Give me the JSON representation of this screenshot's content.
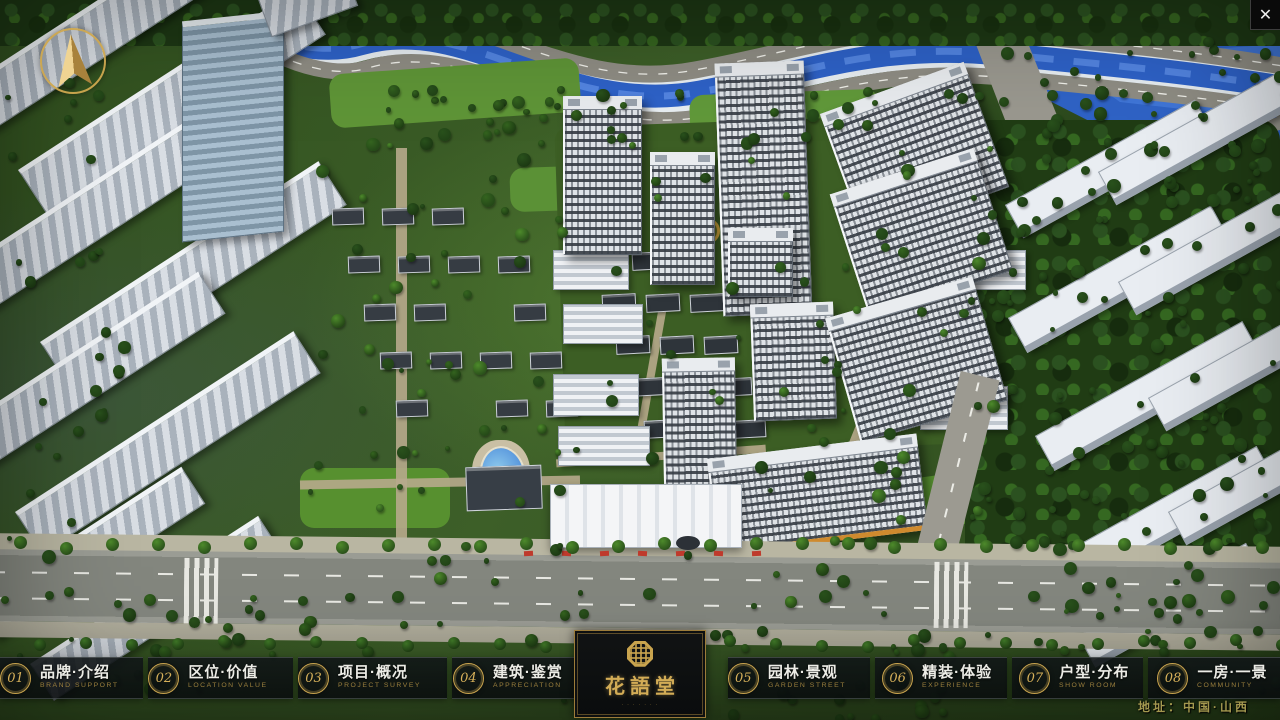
{
  "window": {
    "close_glyph": "✕"
  },
  "project": {
    "logo_title": "花語堂",
    "logo_subtitle": "· · · · · · ·",
    "address": "地址：中国·山西"
  },
  "nav": {
    "items": [
      {
        "num": "01",
        "title": "品牌·介绍",
        "subtitle": "BRAND SUPPORT"
      },
      {
        "num": "02",
        "title": "区位·价值",
        "subtitle": "LOCATION VALUE"
      },
      {
        "num": "03",
        "title": "项目·概况",
        "subtitle": "PROJECT SURVEY"
      },
      {
        "num": "04",
        "title": "建筑·鉴赏",
        "subtitle": "APPRECIATION"
      },
      {
        "num": "05",
        "title": "园林·景观",
        "subtitle": "GARDEN STREET"
      },
      {
        "num": "06",
        "title": "精装·体验",
        "subtitle": "EXPERIENCE"
      },
      {
        "num": "07",
        "title": "户型·分布",
        "subtitle": "SHOW ROOM"
      },
      {
        "num": "08",
        "title": "一房·一景",
        "subtitle": "COMMUNITY"
      }
    ]
  },
  "colors": {
    "accent_gold": "#c9a44e",
    "nav_bg": "#0a0d0f",
    "river_blue": "#2e62c8",
    "address_gold": "#a3984f",
    "label_text": "#ecece6"
  }
}
